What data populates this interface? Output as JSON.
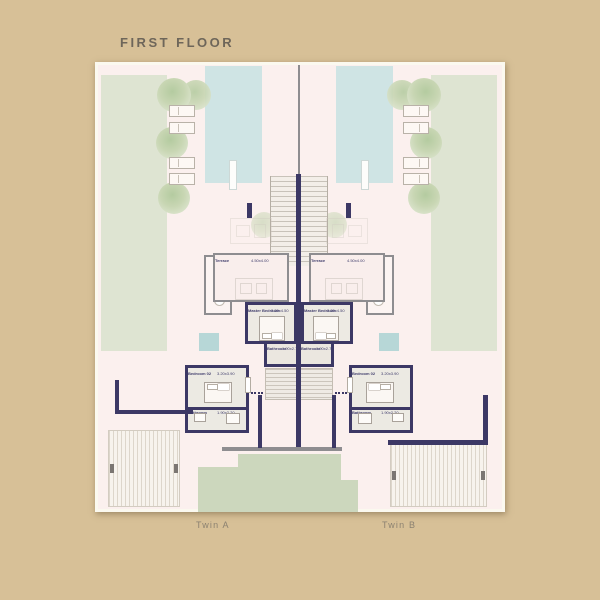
{
  "title": "FIRST FLOOR",
  "plan": {
    "twin_a": {
      "label": "Twin A"
    },
    "twin_b": {
      "label": "Twin B"
    },
    "rooms": {
      "terrace": {
        "name": "Terrace",
        "dims": "4.50x4.00"
      },
      "master_bedroom": {
        "name": "Master Bedroom",
        "dims": "3.20x4.50"
      },
      "bathroom": {
        "name": "Bathroom",
        "dims": "1.90x2.75"
      },
      "bedroom_02": {
        "name": "Bedroom 02",
        "dims": "3.20x3.90"
      },
      "bathroom_02": {
        "name": "Bathroom",
        "dims": "1.90x2.20"
      }
    }
  },
  "colors": {
    "background": "#d7c097",
    "plan_bg": "#fbf0ee",
    "pool": "#cfe4e4",
    "lawn": "#dee4d2",
    "wall": "#3c3865",
    "wall_gray": "#8e8d90",
    "accent_water": "#b7d7d7",
    "garden": "#ccd7bd"
  }
}
